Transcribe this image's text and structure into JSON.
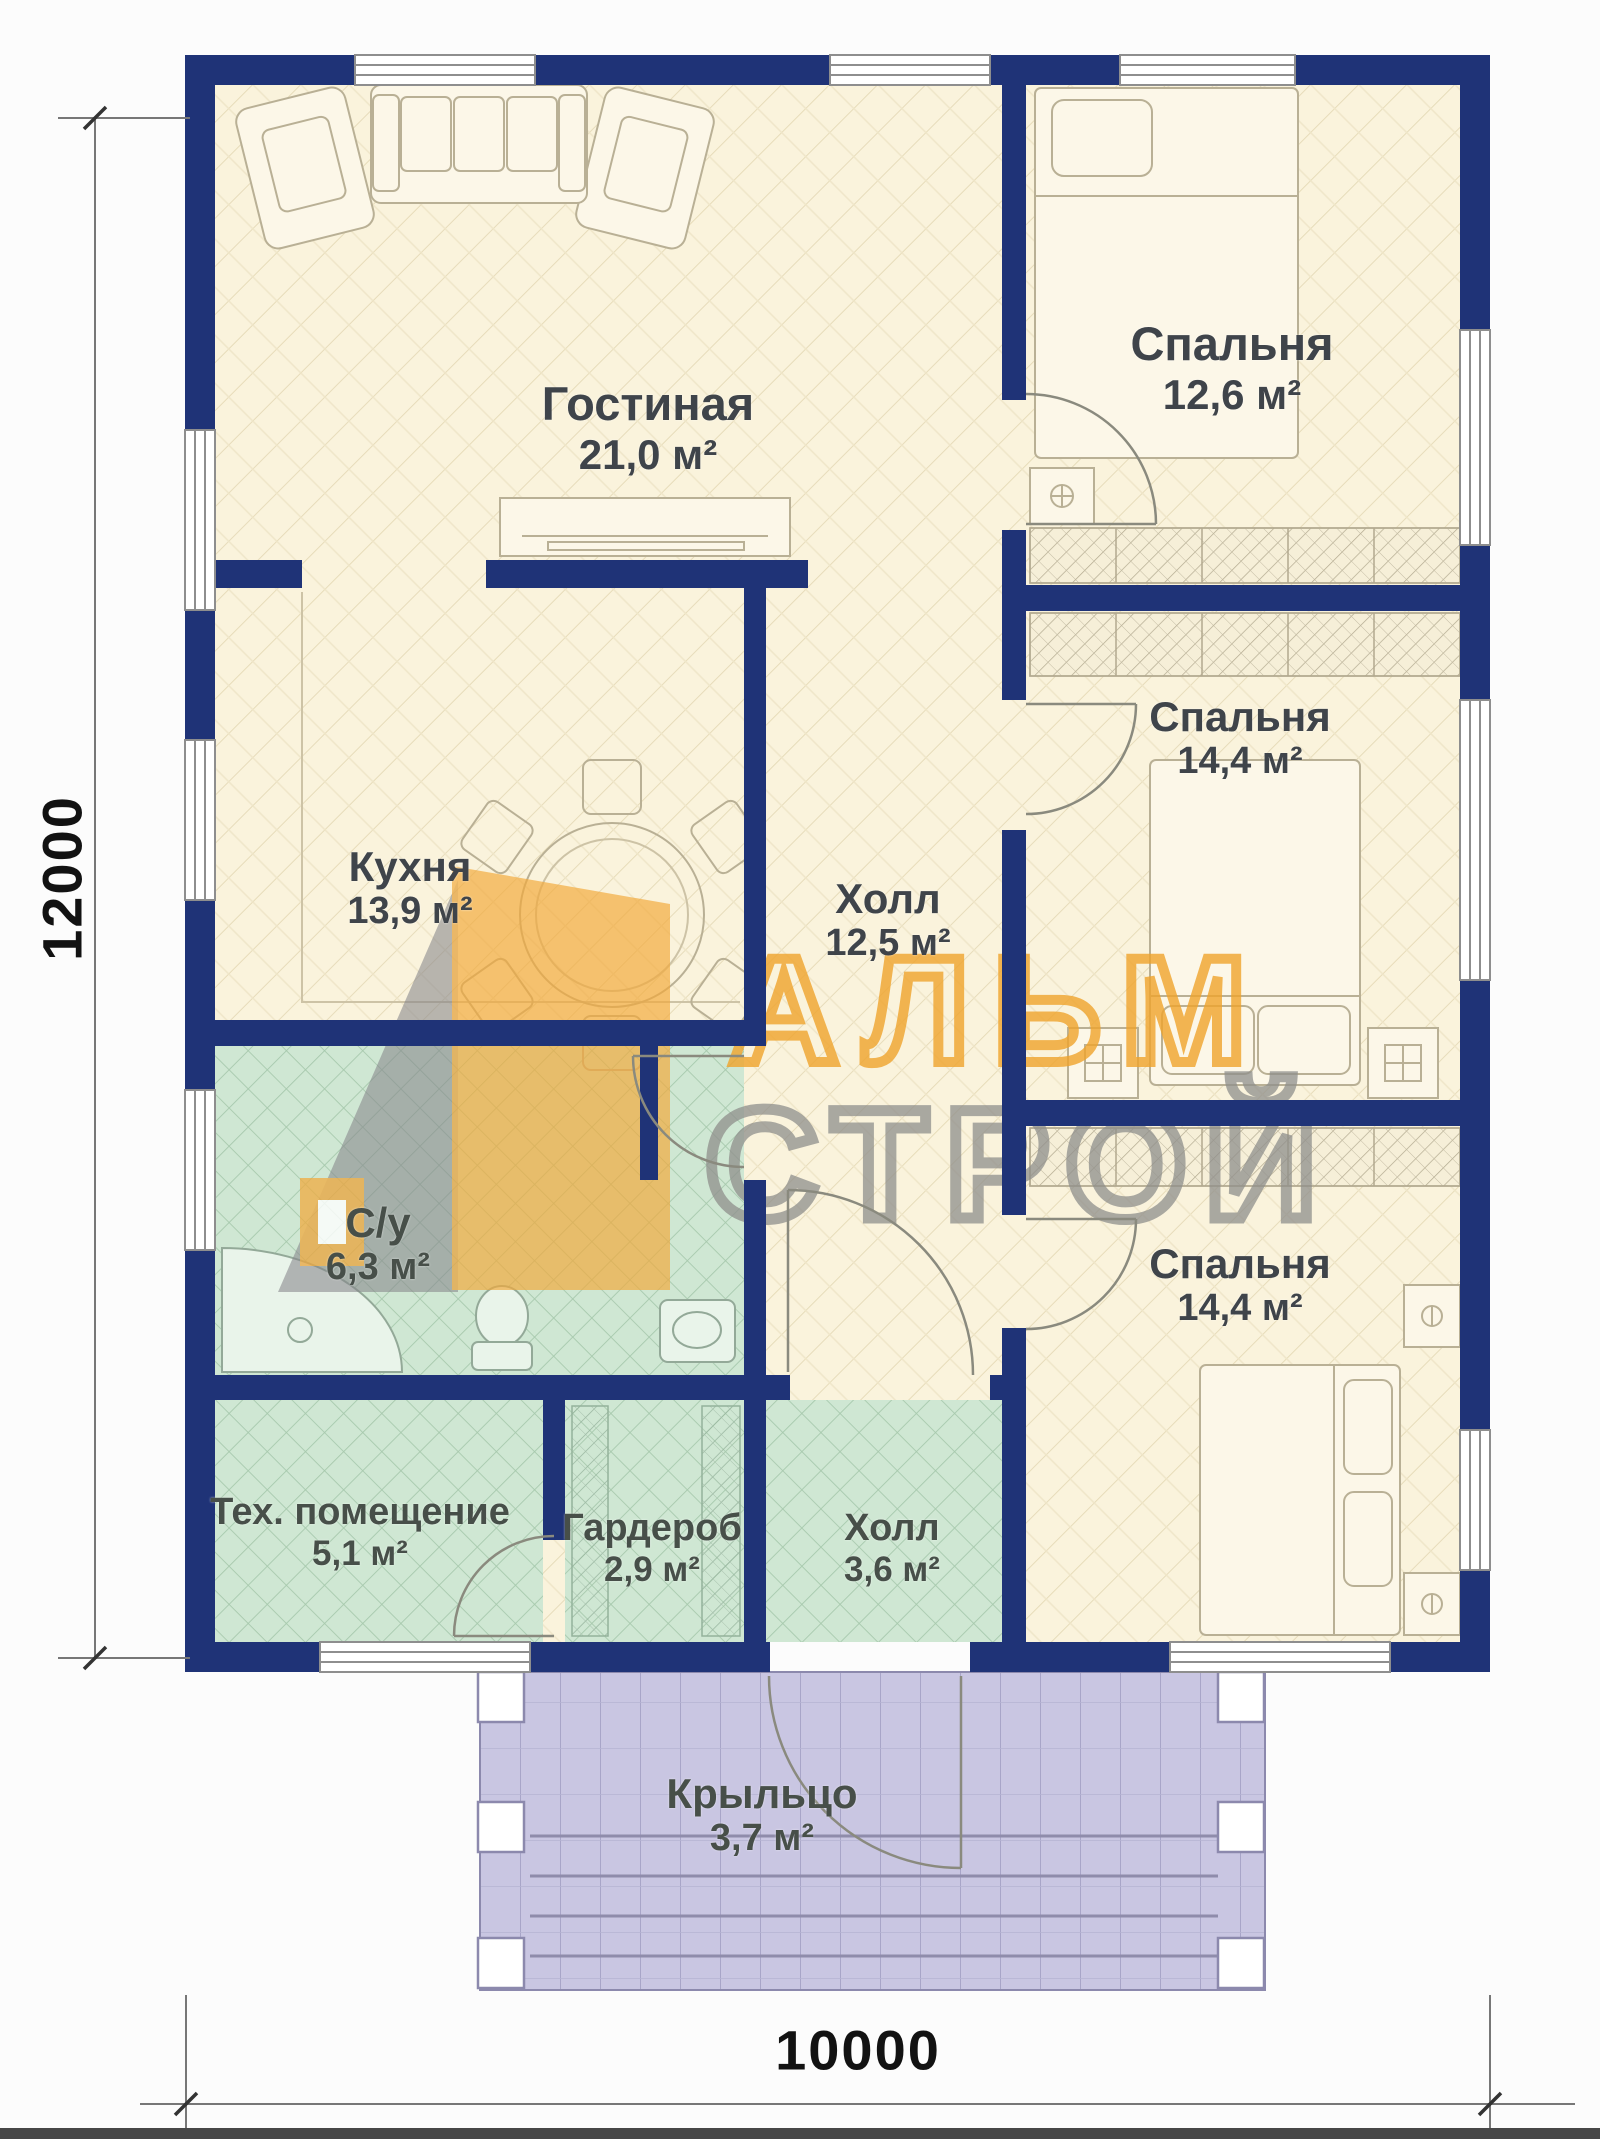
{
  "plan": {
    "dimensions": {
      "height_label": "12000",
      "width_label": "10000"
    },
    "watermark": {
      "line1": "АЛЬМ",
      "line2": "СТРОЙ",
      "accent_color": "#f0a42c",
      "gray_color": "#8f8f8c"
    },
    "colors": {
      "wall": "#1f3377",
      "room_beige": "#faf3dc",
      "room_green": "#cfe7d3",
      "porch_purple": "#c9c6e2",
      "label_text": "#3f444a"
    },
    "rooms": [
      {
        "id": "living",
        "name": "Гостиная",
        "area": "21,0 м²"
      },
      {
        "id": "bedroom1",
        "name": "Спальня",
        "area": "12,6 м²"
      },
      {
        "id": "kitchen",
        "name": "Кухня",
        "area": "13,9 м²"
      },
      {
        "id": "hall",
        "name": "Холл",
        "area": "12,5 м²"
      },
      {
        "id": "bedroom2",
        "name": "Спальня",
        "area": "14,4 м²"
      },
      {
        "id": "bathroom",
        "name": "С/у",
        "area": "6,3 м²"
      },
      {
        "id": "tech",
        "name": "Тех. помещение",
        "area": "5,1 м²"
      },
      {
        "id": "wardrobe",
        "name": "Гардероб",
        "area": "2,9 м²"
      },
      {
        "id": "hall2",
        "name": "Холл",
        "area": "3,6 м²"
      },
      {
        "id": "bedroom3",
        "name": "Спальня",
        "area": "14,4 м²"
      },
      {
        "id": "porch",
        "name": "Крыльцо",
        "area": "3,7 м²"
      }
    ]
  }
}
